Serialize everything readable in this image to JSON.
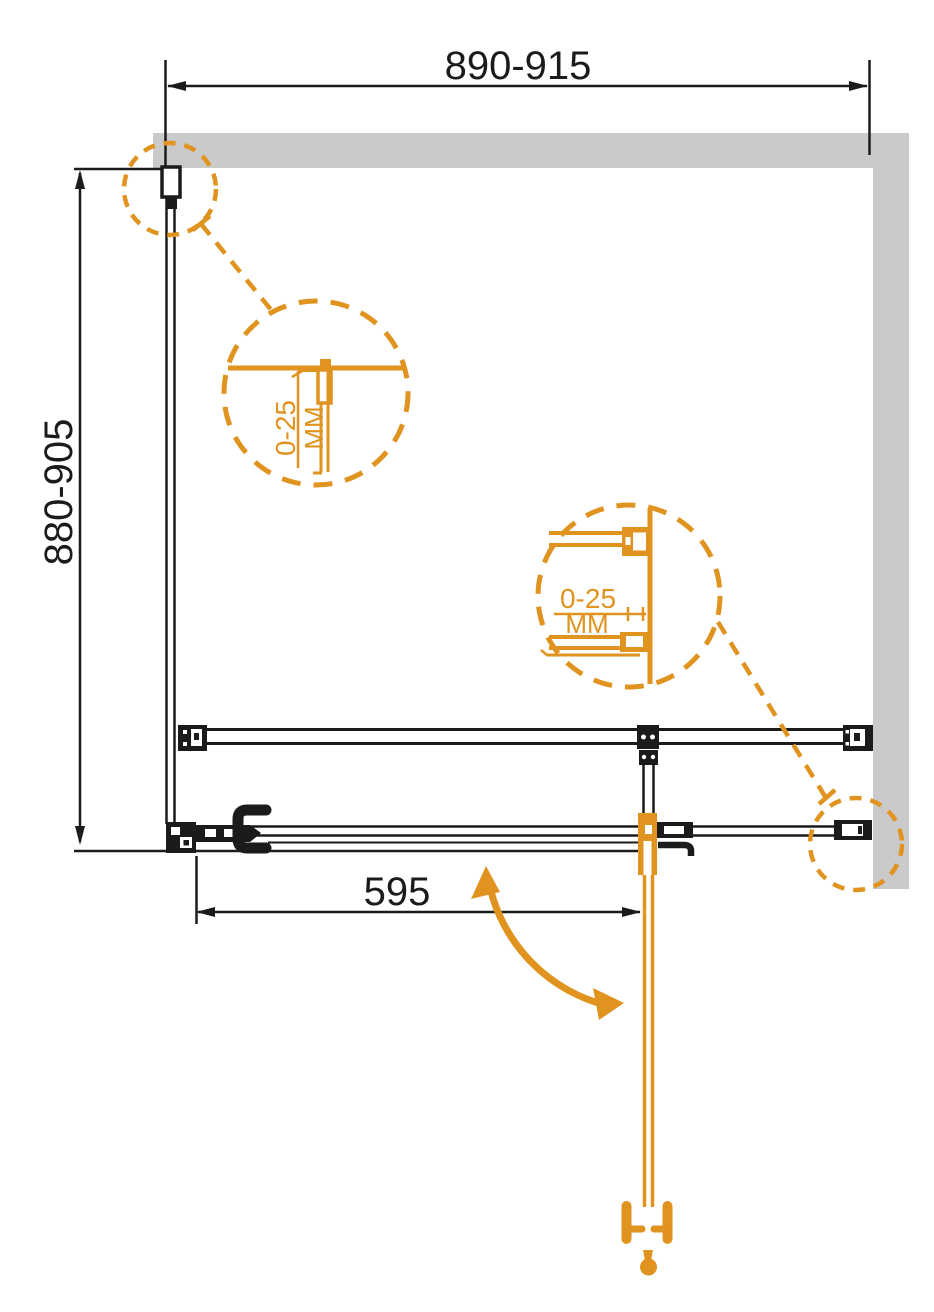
{
  "drawing": {
    "kind": "shower-enclosure-plan-technical-drawing",
    "dimensions": {
      "top_width": "890-915",
      "left_depth": "880-905",
      "door_width": "595"
    },
    "details": {
      "detail_top_profile": {
        "range": "0-25",
        "unit": "MM"
      },
      "detail_wall_bracket": {
        "range": "0-25",
        "unit": "MM"
      }
    },
    "colors": {
      "accent_orange": "#e0931f",
      "line_black": "#1b1b1b",
      "wall_gray": "#cacaca",
      "background": "#ffffff"
    }
  }
}
